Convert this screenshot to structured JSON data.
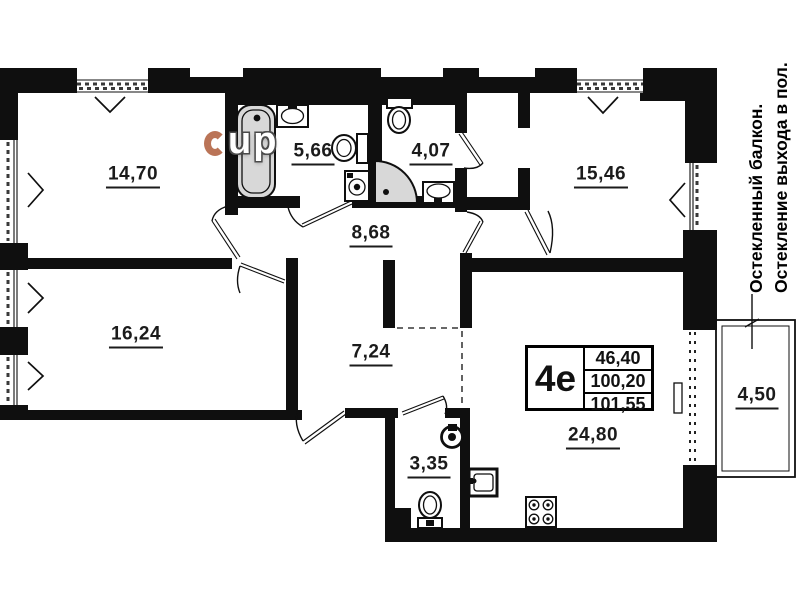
{
  "floor_plan": {
    "watermark": "up",
    "rooms": {
      "bedroom_top_left": {
        "area": "14,70"
      },
      "bathroom": {
        "area": "5,66"
      },
      "toilet_room": {
        "area": "4,07"
      },
      "bedroom_top_right": {
        "area": "15,46"
      },
      "hallway": {
        "area": "8,68"
      },
      "bedroom_bottom_left": {
        "area": "16,24"
      },
      "corridor": {
        "area": "7,24"
      },
      "wc_small": {
        "area": "3,35"
      },
      "kitchen_living": {
        "area": "24,80"
      },
      "balcony": {
        "area": "4,50"
      }
    },
    "info_box": {
      "unit_type": "4е",
      "living_area": "46,40",
      "area_without_balcony": "100,20",
      "total_area": "101,55"
    },
    "side_note": {
      "line1": "Остекленный балкон.",
      "line2": "Остекление выхода в пол."
    },
    "colors": {
      "wall": "#0f0f0f",
      "fixture_fill": "#d8d8d8",
      "background": "#ffffff",
      "watermark_red": "#a9522e"
    }
  }
}
